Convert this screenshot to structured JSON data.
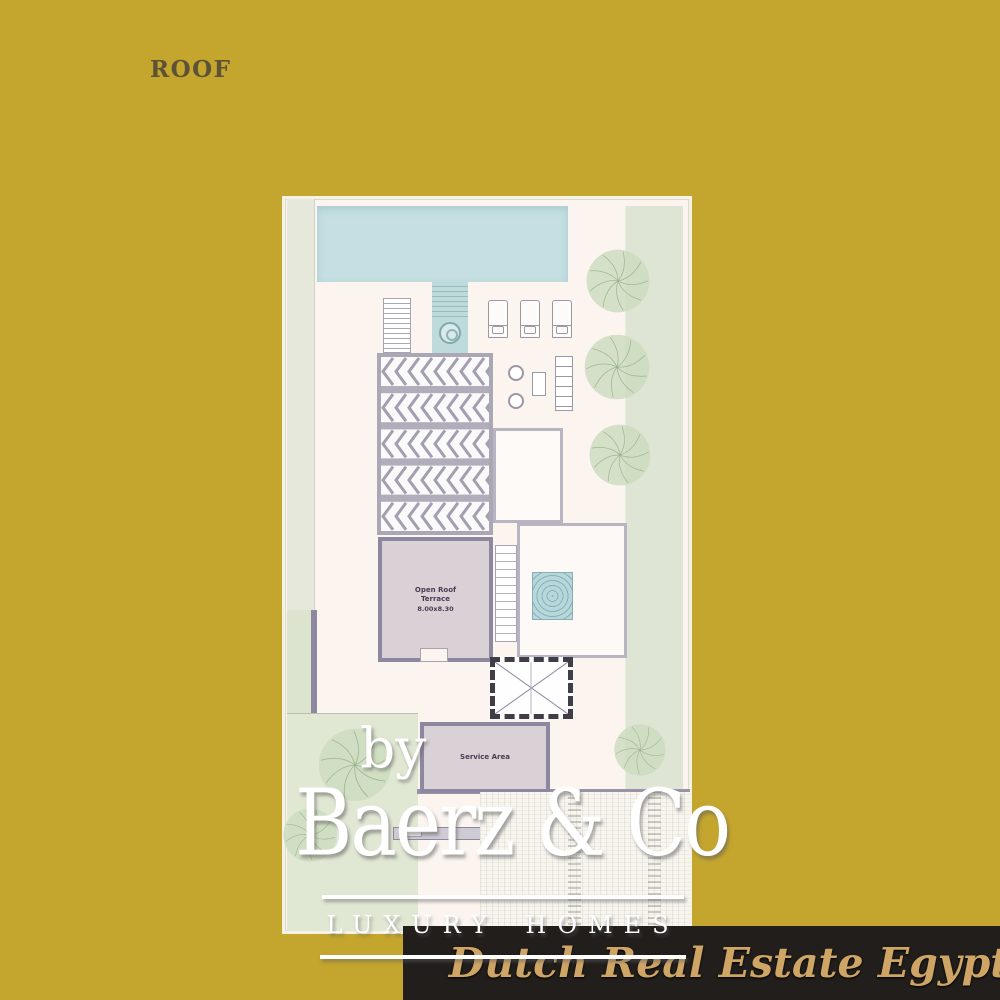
{
  "header": {
    "label": "ROOF"
  },
  "plan": {
    "open_roof_terrace": {
      "line1": "Open Roof",
      "line2": "Terrace",
      "dims": "8.00x8.30"
    },
    "service_area": "Service Area"
  },
  "watermark": {
    "by": "by",
    "brand": "Baerz & Co",
    "tagline": "LUXURY HOMES"
  },
  "banner": {
    "text": "Dutch Real Estate Egypt"
  },
  "colors": {
    "gold_background": "#c4a52e",
    "roof_text": "#5d5236",
    "plan_page": "#fbf4ef",
    "pool": "#c5dfe2",
    "skylight": "#b7d8db",
    "wall": "#8d87a0",
    "room_fill": "#d9d1d6",
    "deck": "#f7f5ee",
    "tree_fill": "#ccdcbf",
    "tree_line": "#95ad85",
    "chevron": "#a49fb0",
    "beam": "#b1adba",
    "banner_bg": "#211e1b",
    "banner_text": "#cfa566",
    "watermark": "#ffffff"
  }
}
